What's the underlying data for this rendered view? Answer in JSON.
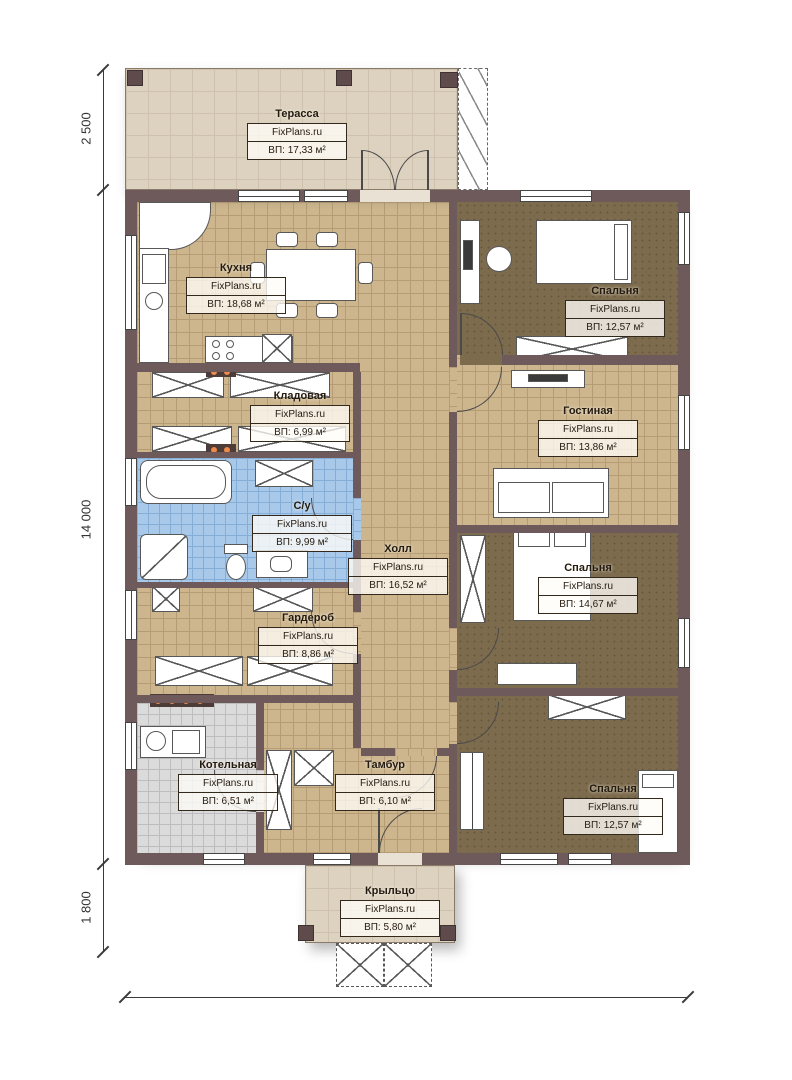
{
  "brand": "FixPlans.ru",
  "rooms": [
    {
      "id": "terrace",
      "name": "Терасса",
      "area": "ВП: 17,33 м²"
    },
    {
      "id": "kitchen",
      "name": "Кухня",
      "area": "ВП: 18,68 м²"
    },
    {
      "id": "bedroom-top",
      "name": "Спальня",
      "area": "ВП: 12,57 м²"
    },
    {
      "id": "living-room",
      "name": "Гостиная",
      "area": "ВП: 13,86 м²"
    },
    {
      "id": "storage",
      "name": "Кладовая",
      "area": "ВП: 6,99 м²"
    },
    {
      "id": "bathroom",
      "name": "С/у",
      "area": "ВП: 9,99 м²"
    },
    {
      "id": "hall",
      "name": "Холл",
      "area": "ВП: 16,52 м²"
    },
    {
      "id": "bedroom-middle",
      "name": "Спальня",
      "area": "ВП: 14,67 м²"
    },
    {
      "id": "wardrobe-room",
      "name": "Гардероб",
      "area": "ВП: 8,86 м²"
    },
    {
      "id": "boiler-room",
      "name": "Котельная",
      "area": "ВП: 6,51 м²"
    },
    {
      "id": "vestibule",
      "name": "Тамбур",
      "area": "ВП: 6,10 м²"
    },
    {
      "id": "bedroom-bottom",
      "name": "Спальня",
      "area": "ВП: 12,57 м²"
    },
    {
      "id": "porch",
      "name": "Крыльцо",
      "area": "ВП: 5,80 м²"
    }
  ],
  "dimensions": {
    "left_top": "2 500",
    "left_middle": "14 000",
    "left_bottom": "1 800",
    "bottom": "11 760"
  },
  "colors": {
    "wall": "#6e5a5a",
    "floor_tile_tan": "#cdb68e",
    "floor_bedroom": "#7d6b4d",
    "floor_bath_blue": "#a9c9ea",
    "floor_boiler_gray": "#dbdbdb",
    "terrace_deck": "#ddd2c0",
    "radiator_dot": "#ef8a4a"
  }
}
